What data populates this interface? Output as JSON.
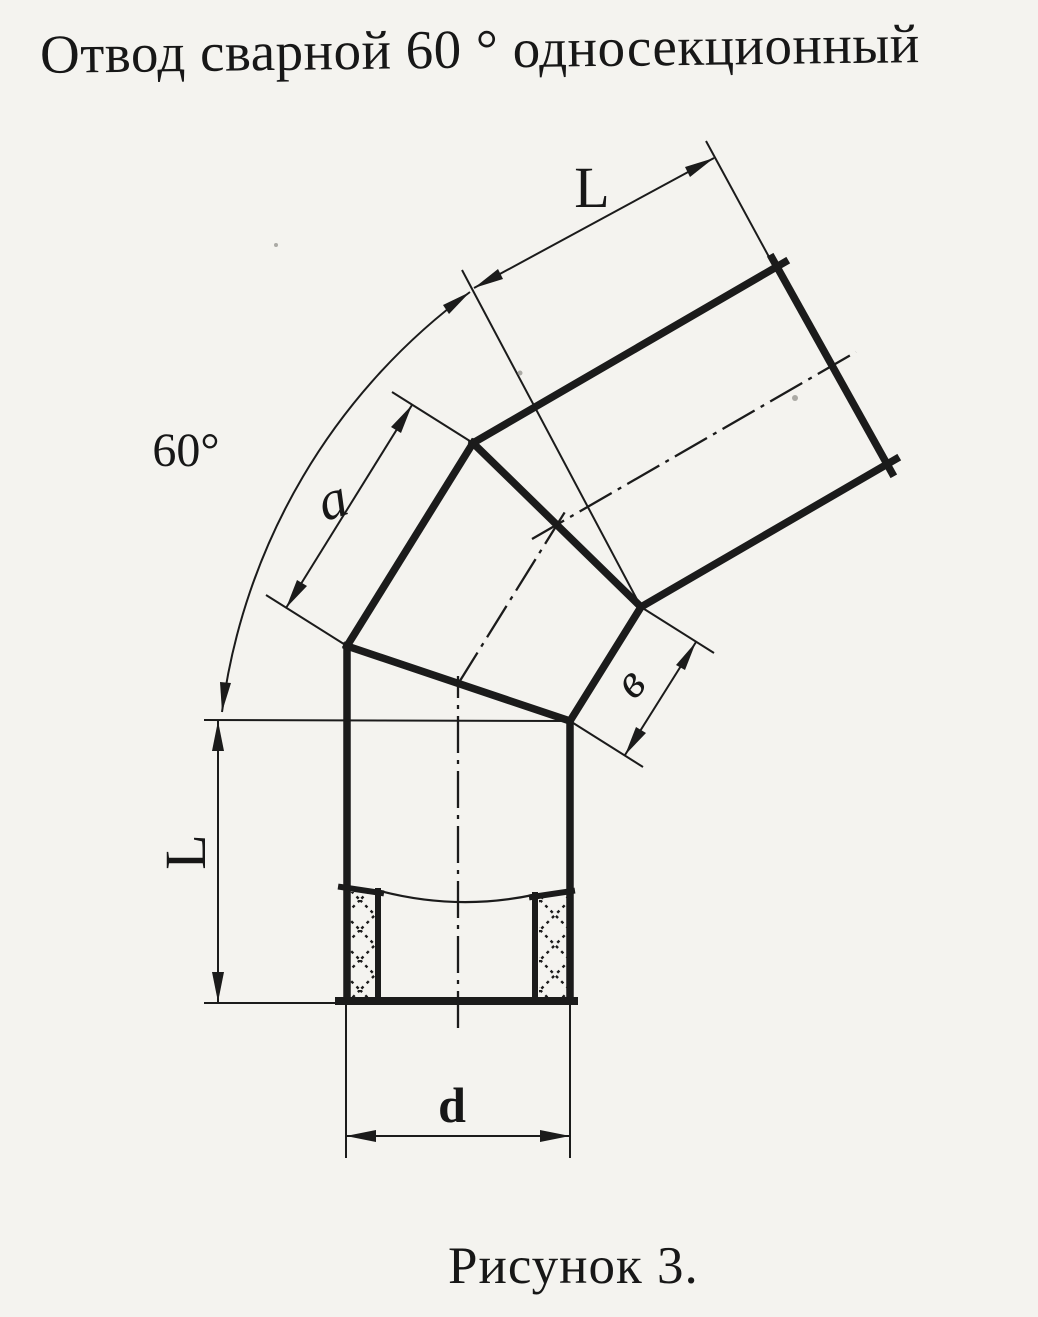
{
  "page": {
    "paper_color": "#f4f3ef",
    "ink_color": "#1b1b1b"
  },
  "title": "Отвод сварной 60 ° односекционный",
  "caption": "Рисунок 3.",
  "dimensions": {
    "angle": "60°",
    "upper_segment_length": "L",
    "lower_segment_length": "L",
    "middle_segment_side": "a",
    "middle_segment_width": "в",
    "pipe_diameter": "d"
  }
}
